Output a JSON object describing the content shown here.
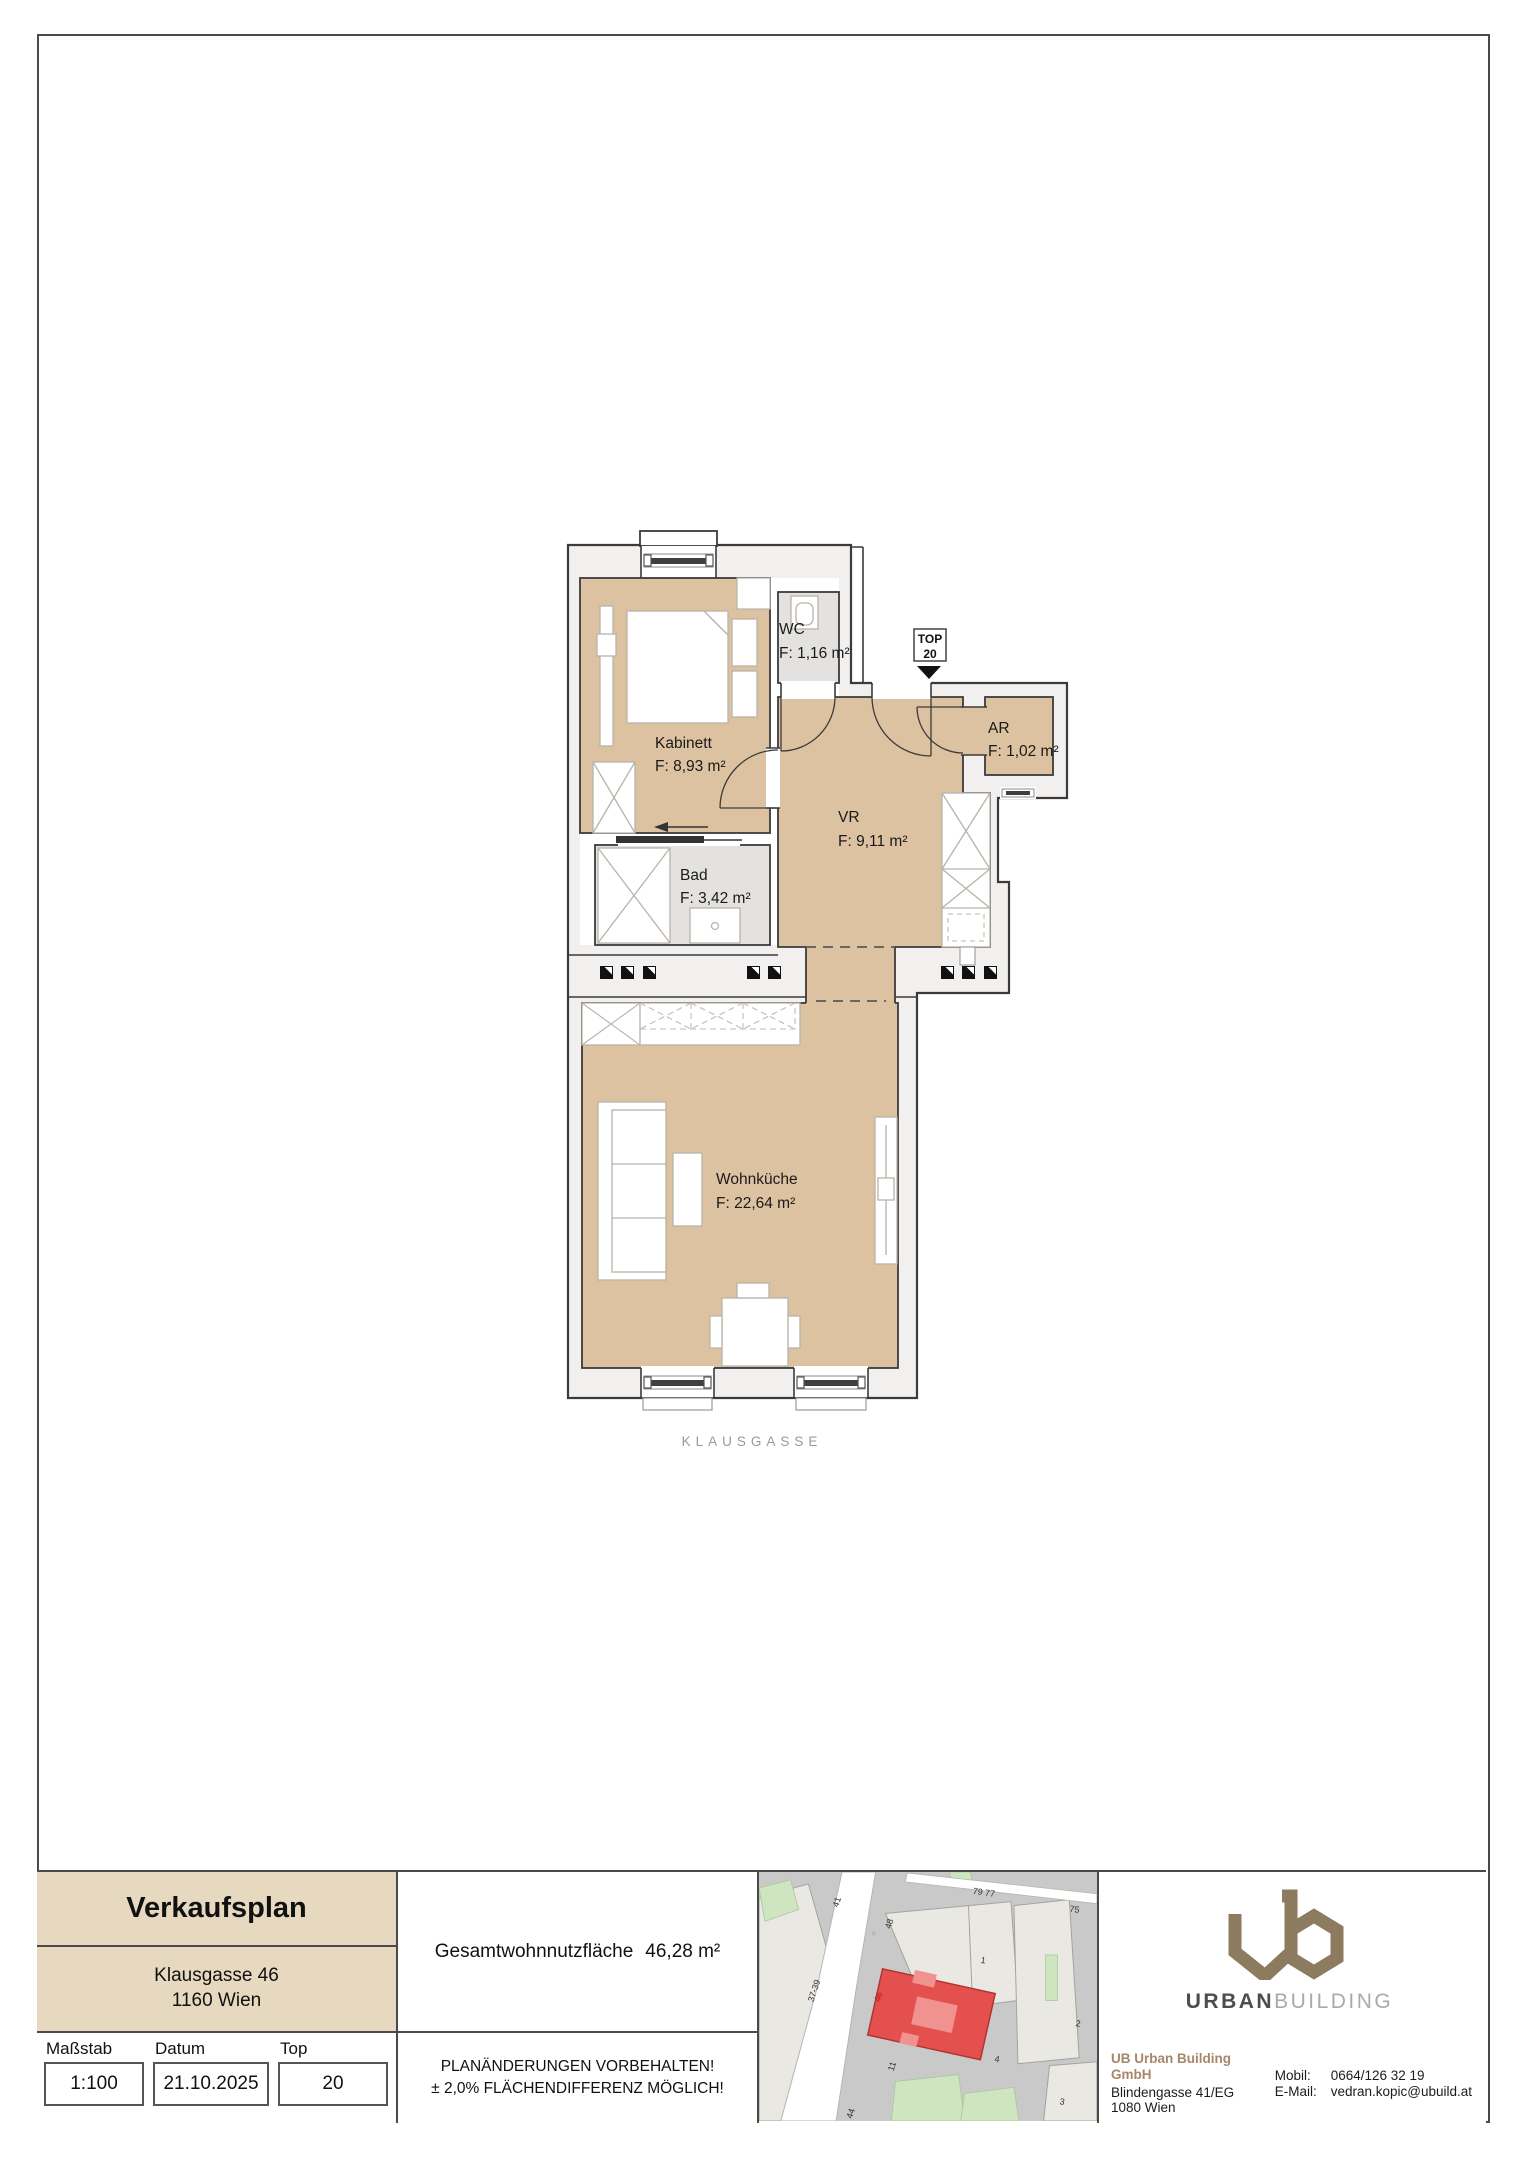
{
  "plan": {
    "rooms": {
      "kabinett": {
        "name": "Kabinett",
        "area": "F: 8,93 m²"
      },
      "wc": {
        "name": "WC",
        "area": "F: 1,16 m²"
      },
      "vr": {
        "name": "VR",
        "area": "F: 9,11 m²"
      },
      "ar": {
        "name": "AR",
        "area": "F: 1,02 m²"
      },
      "bad": {
        "name": "Bad",
        "area": "F: 3,42 m²"
      },
      "wohnkueche": {
        "name": "Wohnküche",
        "area": "F: 22,64 m²"
      }
    },
    "top_marker": {
      "line1": "TOP",
      "line2": "20"
    },
    "street": "KLAUSGASSE"
  },
  "titleblock": {
    "title": "Verkaufsplan",
    "address_line1": "Klausgasse 46",
    "address_line2": "1160 Wien",
    "scale_label": "Maßstab",
    "scale_value": "1:100",
    "date_label": "Datum",
    "date_value": "21.10.2025",
    "top_label": "Top",
    "top_value": "20",
    "total_area_label": "Gesamtwohnnutzfläche",
    "total_area_value": "46,28 m²",
    "notice_line1": "PLANÄNDERUNGEN VORBEHALTEN!",
    "notice_line2": "± 2,0% FLÄCHENDIFFERENZ MÖGLICH!"
  },
  "map": {
    "labels": [
      "41",
      "48",
      "37-39",
      "79 77",
      "75",
      "1",
      "2",
      "4",
      "3",
      "11",
      "44",
      "46"
    ]
  },
  "brand": {
    "wordmark_bold": "URBAN",
    "wordmark_light": "BUILDING",
    "company": "UB Urban Building GmbH",
    "address1": "Blindengasse 41/EG",
    "address2": "1080 Wien",
    "mobile_label": "Mobil:",
    "mobile_value": "0664/126 32 19",
    "email_label": "E-Mail:",
    "email_value": "vedran.kopic@ubuild.at"
  },
  "colors": {
    "room_beige": "#dcc2a0",
    "room_gray": "#e3e2e0",
    "wall_zone": "#f1f0ee",
    "outline": "#3b3b3b",
    "title_beige": "#e7d8c0",
    "map_highlight_red": "#e4504e",
    "brand_taupe": "#8d7b5f"
  }
}
